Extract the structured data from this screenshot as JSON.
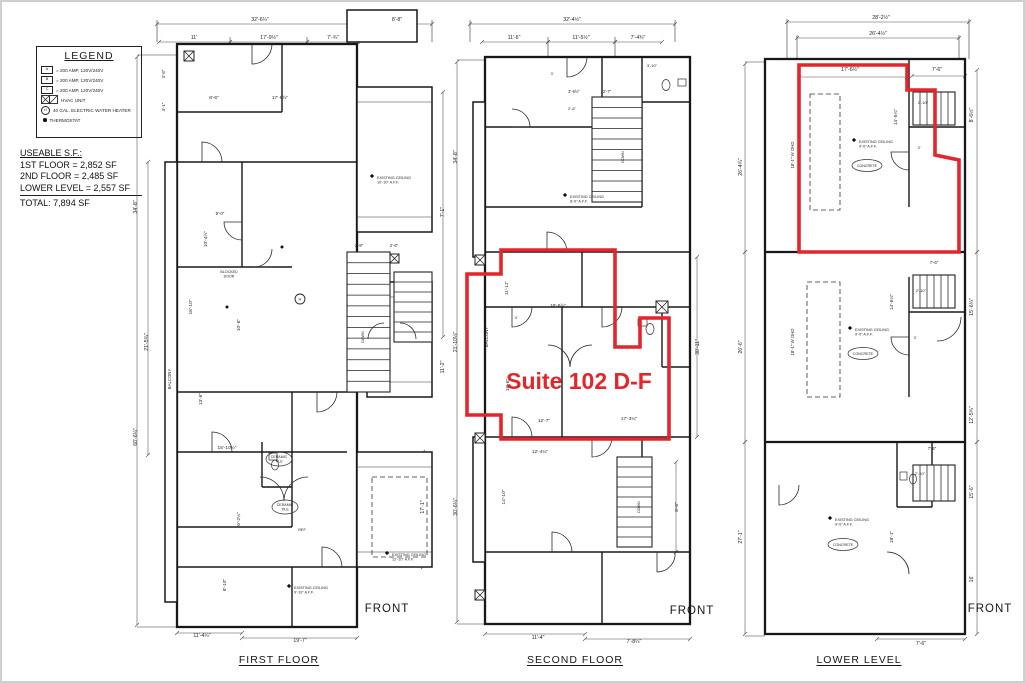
{
  "colors": {
    "suite_outline": "#e4252b",
    "wall": "#181818"
  },
  "legend": {
    "title": "LEGEND",
    "items": [
      {
        "key": "A",
        "label": "= 200 AMP, 120V/240V"
      },
      {
        "key": "B",
        "label": "= 200 AMP, 120V/240V"
      },
      {
        "key": "C",
        "label": "= 200 AMP, 120V/240V"
      },
      {
        "key": "",
        "label": "HVAC UNIT"
      },
      {
        "key": "H",
        "label": "40 GAL. ELECTRIC WATER HEATER"
      },
      {
        "key": "",
        "label": "THERMOSTAT"
      }
    ]
  },
  "useable_sf": {
    "title": "USEABLE S.F.:",
    "lines": [
      "1ST FLOOR = 2,852 SF",
      "2ND FLOOR = 2,485 SF",
      "LOWER LEVEL = 2,557 SF"
    ],
    "total": "TOTAL:  7,894 SF"
  },
  "suite_overlay": {
    "label": "Suite 102 D-F"
  },
  "plans": [
    {
      "id": "first-floor",
      "title": "FIRST FLOOR",
      "front_label": "FRONT",
      "labels": [
        {
          "t": "32'-6¼\"",
          "x": 128,
          "y": 14
        },
        {
          "t": "8'-8\"",
          "x": 265,
          "y": 14
        },
        {
          "t": "11'",
          "x": 62,
          "y": 32
        },
        {
          "t": "17'-9½\"",
          "x": 137,
          "y": 32
        },
        {
          "t": "7'-¾\"",
          "x": 201,
          "y": 32
        },
        {
          "t": "34'-8\"",
          "x": 5,
          "y": 200,
          "r": -90
        },
        {
          "t": "60'-6¼\"",
          "x": 5,
          "y": 430,
          "r": -90
        },
        {
          "t": "21'-5¾\"",
          "x": 16,
          "y": 335,
          "r": -90
        },
        {
          "t": "BALCONY",
          "x": 39,
          "y": 372,
          "r": -90,
          "fs": 4.3
        },
        {
          "t": "8'-6\"",
          "x": 82,
          "y": 92,
          "fs": 4.8
        },
        {
          "t": "17'-9½\"",
          "x": 148,
          "y": 92,
          "fs": 4.8
        },
        {
          "t": "3'-6\"",
          "x": 33,
          "y": 67,
          "r": -90,
          "fs": 4.4
        },
        {
          "t": "4'-1\"",
          "x": 33,
          "y": 100,
          "r": -90,
          "fs": 4.4
        },
        {
          "t": "9'-0\"",
          "x": 88,
          "y": 208,
          "fs": 4.4
        },
        {
          "t": "10'-4½\"",
          "x": 75,
          "y": 232,
          "r": -90,
          "fs": 4.8
        },
        {
          "t": "16'-10\"",
          "x": 60,
          "y": 300,
          "r": -90,
          "fs": 4.8
        },
        {
          "t": "10'-6\"",
          "x": 108,
          "y": 318,
          "r": -90,
          "fs": 4.8
        },
        {
          "t": "2'-8\"",
          "x": 227,
          "y": 240,
          "fs": 4.2
        },
        {
          "t": "2'-6\"",
          "x": 262,
          "y": 240,
          "fs": 4.2
        },
        {
          "t": "7'-1\"",
          "x": 312,
          "y": 205,
          "r": -90
        },
        {
          "t": "11'-2\"",
          "x": 312,
          "y": 360,
          "r": -90
        },
        {
          "t": "17'-1\"",
          "x": 292,
          "y": 500,
          "r": -90
        },
        {
          "t": "15'-10½\"",
          "x": 95,
          "y": 442,
          "fs": 4.8
        },
        {
          "t": "13'-6\"",
          "x": 70,
          "y": 392,
          "r": -90,
          "fs": 4.8
        },
        {
          "t": "6'-2¼\"",
          "x": 108,
          "y": 512,
          "r": -90,
          "fs": 4.8
        },
        {
          "t": "8'-10\"",
          "x": 94,
          "y": 578,
          "r": -90,
          "fs": 4.8
        },
        {
          "t": "11'-4¼\"",
          "x": 70,
          "y": 630
        },
        {
          "t": "19'-7\"",
          "x": 168,
          "y": 635
        },
        {
          "t": "DOWN",
          "x": 232,
          "y": 330,
          "r": -90,
          "fs": 3.6
        },
        {
          "t": "REF",
          "x": 170,
          "y": 524,
          "fs": 3.8
        },
        {
          "t": "CERAMIC",
          "t2": "TILE",
          "x": 147,
          "y": 451,
          "oval": 1,
          "rx": 13,
          "ry": 7,
          "fs": 3.6
        },
        {
          "t": "CERAMIC",
          "t2": "TILE",
          "x": 153,
          "y": 499,
          "oval": 1,
          "rx": 13,
          "ry": 7,
          "fs": 3.6
        },
        {
          "t": "BLOCKED",
          "t2": "DOOR",
          "x": 97,
          "y": 266,
          "fs": 3.6
        },
        {
          "t": "EXISTING CEILING",
          "t2": "10'-10\" A.F.F.",
          "x": 245,
          "y": 172,
          "sym": 1,
          "a": "s",
          "fs": 3.8
        },
        {
          "t": "EXISTING CEILING",
          "t2": "12'-10\" A.F.F.",
          "x": 260,
          "y": 549,
          "sym": 1,
          "a": "s",
          "fs": 3.8
        },
        {
          "t": "EXISTING CEILING",
          "t2": "9'-10\" A.F.F.",
          "x": 162,
          "y": 582,
          "sym": 1,
          "a": "s",
          "fs": 3.8
        }
      ]
    },
    {
      "id": "second-floor",
      "title": "SECOND FLOOR",
      "front_label": "FRONT",
      "labels": [
        {
          "t": "32'-4½\"",
          "x": 120,
          "y": 14
        },
        {
          "t": "11'-6\"",
          "x": 62,
          "y": 32
        },
        {
          "t": "11'-5½\"",
          "x": 129,
          "y": 32
        },
        {
          "t": "7'-4¾\"",
          "x": 186,
          "y": 32
        },
        {
          "t": "34'-8\"",
          "x": 5,
          "y": 150,
          "r": -90
        },
        {
          "t": "21'-10¼\"",
          "x": 5,
          "y": 335,
          "r": -90
        },
        {
          "t": "30'-6¼\"",
          "x": 5,
          "y": 500,
          "r": -90
        },
        {
          "t": "BALCONY",
          "x": 36,
          "y": 330,
          "r": -90,
          "fs": 4.3
        },
        {
          "t": "3'-6½\"",
          "x": 122,
          "y": 86,
          "fs": 4.2
        },
        {
          "t": "2'-7\"",
          "x": 155,
          "y": 86,
          "fs": 4.2
        },
        {
          "t": "2'-6\"",
          "x": 120,
          "y": 103,
          "fs": 4
        },
        {
          "t": "3'-10\"",
          "x": 200,
          "y": 60,
          "fs": 4
        },
        {
          "t": "11'-11\"",
          "x": 56,
          "y": 281,
          "r": -90,
          "fs": 4.8
        },
        {
          "t": "18'-6½\"",
          "x": 106,
          "y": 300,
          "fs": 4.8
        },
        {
          "t": "16'-6\"",
          "x": 57,
          "y": 378,
          "r": -90,
          "fs": 4.8
        },
        {
          "t": "12'-7\"",
          "x": 92,
          "y": 415,
          "fs": 4.8
        },
        {
          "t": "17'-3¼\"",
          "x": 177,
          "y": 413,
          "fs": 4.8
        },
        {
          "t": "12'-4¼\"",
          "x": 88,
          "y": 446,
          "fs": 4.8
        },
        {
          "t": "14'-10\"",
          "x": 53,
          "y": 490,
          "r": -90,
          "fs": 4.8
        },
        {
          "t": "30'-11\"",
          "x": 247,
          "y": 340,
          "r": -90
        },
        {
          "t": "8'-6\"",
          "x": 226,
          "y": 500,
          "r": -90,
          "fs": 4.8
        },
        {
          "t": "11'-4\"",
          "x": 86,
          "y": 632
        },
        {
          "t": "7'-8¼\"",
          "x": 182,
          "y": 636
        },
        {
          "t": "3'",
          "x": 100,
          "y": 68,
          "fs": 3.8
        },
        {
          "t": "3'",
          "x": 64,
          "y": 312,
          "fs": 3.8
        },
        {
          "t": "DOWN",
          "x": 172,
          "y": 150,
          "r": -90,
          "fs": 3.6
        },
        {
          "t": "DOWN",
          "x": 188,
          "y": 500,
          "r": -90,
          "fs": 3.6
        },
        {
          "t": "EXISTING CEILING",
          "t2": "8'-0\" A.F.F.",
          "x": 118,
          "y": 191,
          "sym": 1,
          "a": "s",
          "fs": 3.8
        }
      ]
    },
    {
      "id": "lower-level",
      "title": "LOWER LEVEL",
      "front_label": "FRONT",
      "labels": [
        {
          "t": "28'-2½\"",
          "x": 144,
          "y": 12
        },
        {
          "t": "26'-4½\"",
          "x": 141,
          "y": 28
        },
        {
          "t": "17'-6½\"",
          "x": 113,
          "y": 64
        },
        {
          "t": "7'-6\"",
          "x": 200,
          "y": 64
        },
        {
          "t": "26'-4¾\"",
          "x": 5,
          "y": 160,
          "r": -90
        },
        {
          "t": "26'-6\"",
          "x": 5,
          "y": 340,
          "r": -90
        },
        {
          "t": "27'-1\"",
          "x": 5,
          "y": 530,
          "r": -90
        },
        {
          "t": "18'-1\" W OHD",
          "x": 57,
          "y": 148,
          "r": -90,
          "fs": 4.3
        },
        {
          "t": "18'-1\" W OHD",
          "x": 57,
          "y": 335,
          "r": -90,
          "fs": 4.3
        },
        {
          "t": "8'-6½\"",
          "x": 236,
          "y": 108,
          "r": -90
        },
        {
          "t": "15'-6¼\"",
          "x": 236,
          "y": 300,
          "r": -90
        },
        {
          "t": "12'-5¾\"",
          "x": 236,
          "y": 408,
          "r": -90
        },
        {
          "t": "15'-6\"",
          "x": 236,
          "y": 485,
          "r": -90
        },
        {
          "t": "16'",
          "x": 236,
          "y": 572,
          "r": -90
        },
        {
          "t": "14'-5¼\"",
          "x": 160,
          "y": 110,
          "r": -90,
          "fs": 4.8
        },
        {
          "t": "14'-6¼\"",
          "x": 156,
          "y": 295,
          "r": -90,
          "fs": 4.8
        },
        {
          "t": "18'-1\"",
          "x": 156,
          "y": 530,
          "r": -90,
          "fs": 4.8
        },
        {
          "t": "2'-10\"",
          "x": 186,
          "y": 97,
          "fs": 4
        },
        {
          "t": "2'-10\"",
          "x": 184,
          "y": 285,
          "fs": 4
        },
        {
          "t": "2'-10\"",
          "x": 183,
          "y": 468,
          "fs": 4
        },
        {
          "t": "7'-6\"",
          "x": 197,
          "y": 257,
          "fs": 4.3
        },
        {
          "t": "7'-6\"",
          "x": 195,
          "y": 443,
          "fs": 4.3
        },
        {
          "t": "7'-6\"",
          "x": 184,
          "y": 638
        },
        {
          "t": "3'",
          "x": 178,
          "y": 332,
          "fs": 3.8
        },
        {
          "t": "3'",
          "x": 182,
          "y": 142,
          "fs": 3.8
        },
        {
          "t": "EXISTING CEILING",
          "t2": "9'-0\" A.F.F.",
          "x": 122,
          "y": 136,
          "sym": 1,
          "a": "s",
          "fs": 3.8
        },
        {
          "t": "CONCRETE",
          "x": 130,
          "y": 160,
          "oval": 1,
          "rx": 15,
          "ry": 6,
          "fs": 3.6
        },
        {
          "t": "EXISTING CEILING",
          "t2": "9'-0\" A.F.F.",
          "x": 118,
          "y": 324,
          "sym": 1,
          "a": "s",
          "fs": 3.8
        },
        {
          "t": "CONCRETE",
          "x": 126,
          "y": 348,
          "oval": 1,
          "rx": 15,
          "ry": 6,
          "fs": 3.6
        },
        {
          "t": "EXISTING CEILING",
          "t2": "9'-0\" A.F.F.",
          "x": 98,
          "y": 514,
          "sym": 1,
          "a": "s",
          "fs": 3.8
        },
        {
          "t": "CONCRETE",
          "x": 106,
          "y": 539,
          "oval": 1,
          "rx": 15,
          "ry": 6,
          "fs": 3.6
        }
      ]
    }
  ]
}
